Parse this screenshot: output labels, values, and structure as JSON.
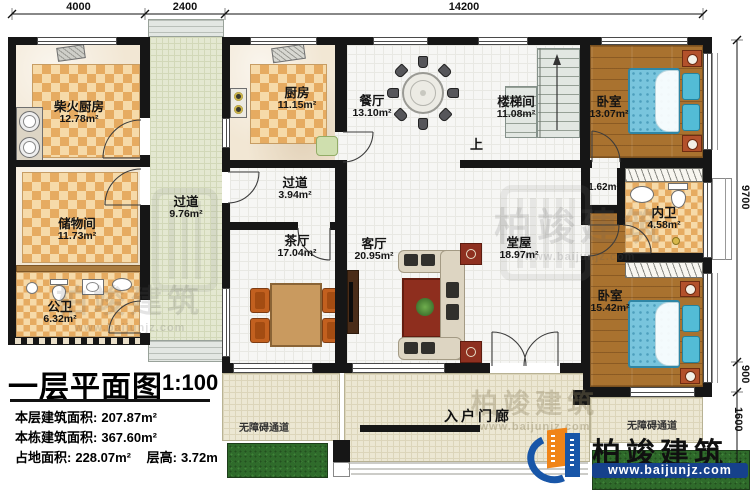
{
  "plan": {
    "rooms": [
      {
        "name": "柴火厨房",
        "area": "12.78m²"
      },
      {
        "name": "储物间",
        "area": "11.73m²"
      },
      {
        "name": "公卫",
        "area": "6.32m²"
      },
      {
        "name": "过道",
        "area": "9.76m²"
      },
      {
        "name": "厨房",
        "area": "11.15m²"
      },
      {
        "name": "餐厅",
        "area": "13.10m²"
      },
      {
        "name": "楼梯间",
        "area": "11.08m²"
      },
      {
        "name": "卧室",
        "area": "13.07m²"
      },
      {
        "name": "过道",
        "area": "3.94m²"
      },
      {
        "name": "茶厅",
        "area": "17.04m²"
      },
      {
        "name": "客厅",
        "area": "20.95m²"
      },
      {
        "name": "堂屋",
        "area": "18.97m²"
      },
      {
        "name": "内卫",
        "area": "4.58m²"
      },
      {
        "name": "卧室",
        "area": "15.42m²"
      }
    ],
    "annotations": {
      "closet_area": "1.62m²",
      "stairs_up": "上",
      "entry_porch": "入户门廊",
      "accessible_path_left": "无障碍通道",
      "accessible_path_right": "无障碍通道"
    },
    "dimensions": {
      "top": [
        "4000",
        "2400",
        "14200"
      ],
      "right": [
        "9700",
        "900",
        "1600"
      ]
    }
  },
  "title_block": {
    "title": "一层平面图",
    "scale": "1:100",
    "stats": [
      {
        "label": "本层建筑面积:",
        "value": "207.87m²"
      },
      {
        "label": "本栋建筑面积:",
        "value": "367.60m²"
      },
      {
        "label": "占地面积:",
        "value": "228.07m²"
      },
      {
        "label": "层高:",
        "value": "3.72m"
      }
    ]
  },
  "brand": {
    "name": "柏竣建筑",
    "website": "www.baijunjz.com"
  },
  "watermark": {
    "text": "柏竣建筑",
    "sub": "www.baijunjz.com"
  }
}
